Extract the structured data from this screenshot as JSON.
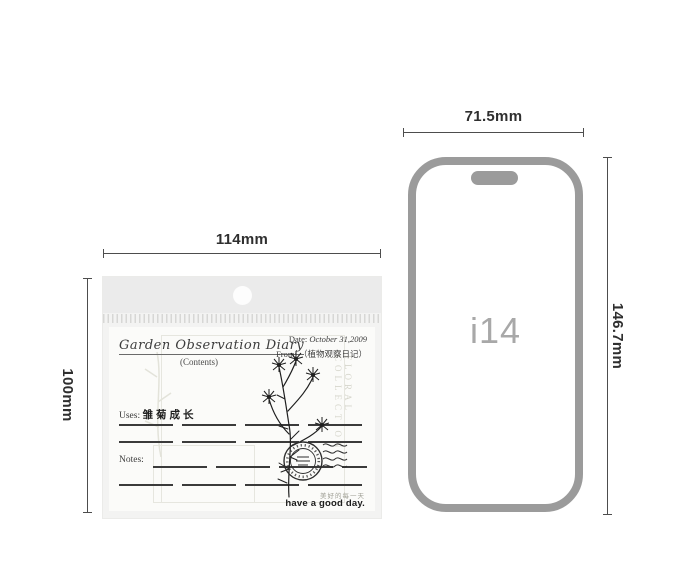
{
  "dims": {
    "package_width": "114mm",
    "package_height": "100mm",
    "phone_width": "71.5mm",
    "phone_height": "146.7mm"
  },
  "phone": {
    "model": "i14",
    "border_color": "#9b9b9b"
  },
  "card": {
    "title": "Garden Observation Diary",
    "contents": "(Contents)",
    "date_label": "Date:",
    "date_value": "October 31,2009",
    "from_label": "From:",
    "from_value": "（植物观察日记）",
    "uses_label": "Uses:",
    "uses_value": "雏菊成长",
    "notes_label": "Notes:",
    "collection": "FLORAL COLLECTION",
    "footer_cn": "美好的每一天",
    "footer_en": "have a good day."
  },
  "colors": {
    "background": "#ffffff",
    "bag_flap": "#ebebeb",
    "bag_body": "#f3f3f2",
    "card_bg": "#fbfbf9",
    "dimension_line": "#4d4d4d",
    "phone_border": "#9b9b9b",
    "ink": "#2a2a2a"
  }
}
